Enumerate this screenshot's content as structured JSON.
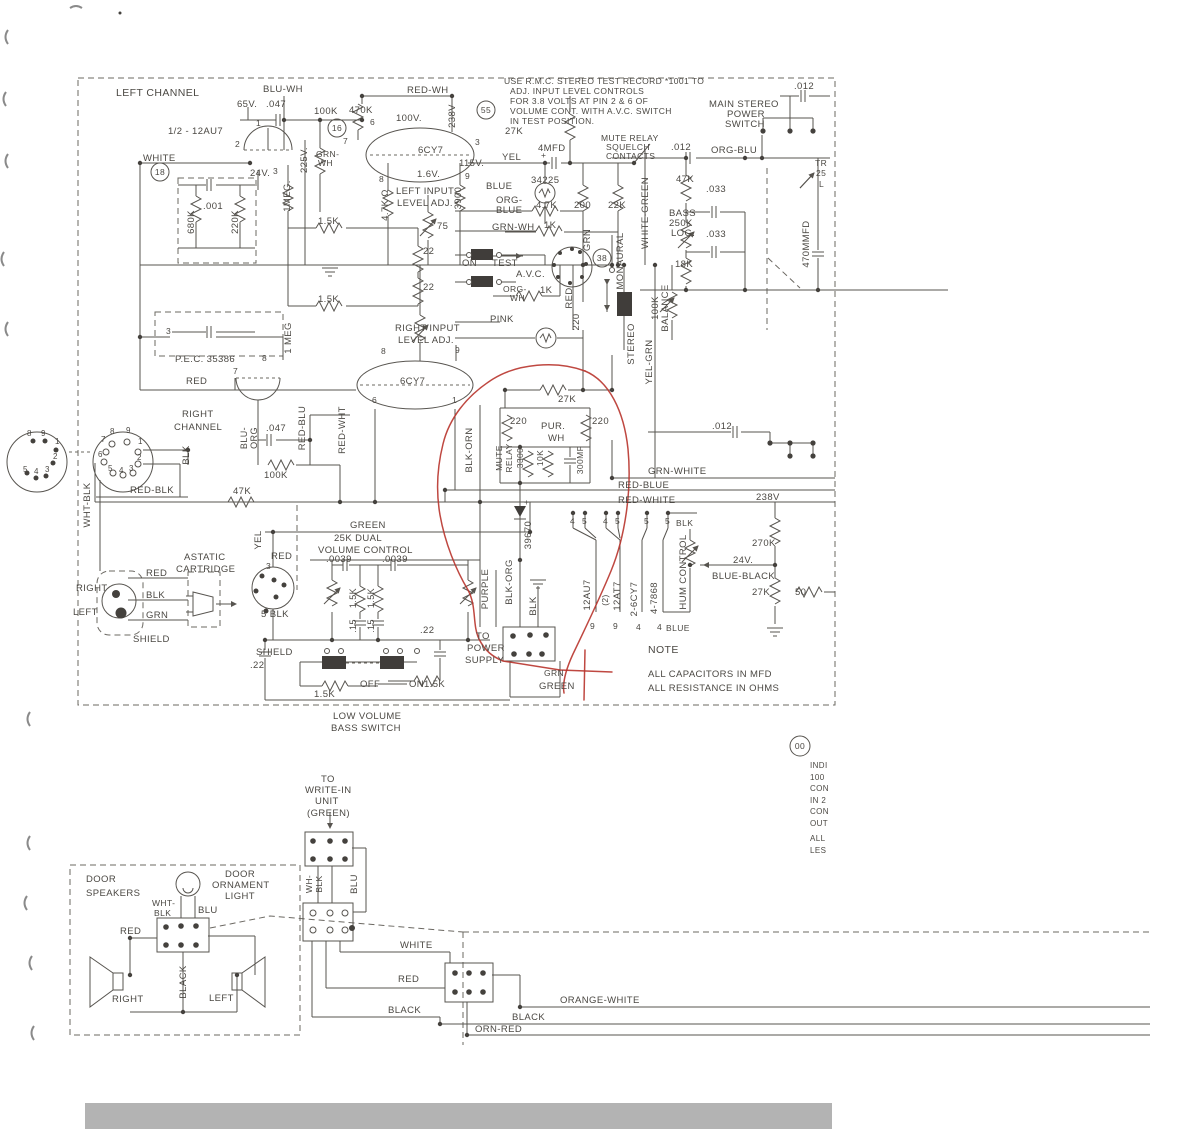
{
  "style": {
    "ink_color": "#4b4843",
    "red_annotation_color": "#b8342c",
    "scan_bar_color": "#b3b3b3",
    "background": "#ffffff"
  },
  "circled_refs": [
    {
      "t": "18",
      "x": 160,
      "y": 172
    },
    {
      "t": "16",
      "x": 337,
      "y": 128
    },
    {
      "t": "55",
      "x": 486,
      "y": 110
    },
    {
      "t": "38",
      "x": 602,
      "y": 258
    },
    {
      "t": "00",
      "x": 800,
      "y": 746
    }
  ],
  "labels": [
    {
      "t": "USE R.M.C. STEREO TEST RECORD *1001 TO",
      "x": 504,
      "y": 84,
      "s": 8.5
    },
    {
      "t": "ADJ. INPUT LEVEL CONTROLS",
      "x": 510,
      "y": 94,
      "s": 8.5
    },
    {
      "t": "FOR 3.8 VOLTS AT PIN 2 & 6 OF",
      "x": 510,
      "y": 104,
      "s": 8.5
    },
    {
      "t": "VOLUME CONT. WITH A.V.C. SWITCH",
      "x": 510,
      "y": 114,
      "s": 8.5
    },
    {
      "t": "IN TEST POSITION.",
      "x": 510,
      "y": 124,
      "s": 8.5
    },
    {
      "t": "LEFT CHANNEL",
      "x": 116,
      "y": 96,
      "s": 10.5
    },
    {
      "t": "1/2 - 12AU7",
      "x": 168,
      "y": 134
    },
    {
      "t": "WHITE",
      "x": 143,
      "y": 161
    },
    {
      "t": "BLU-WH",
      "x": 263,
      "y": 92
    },
    {
      "t": "65V.",
      "x": 237,
      "y": 107
    },
    {
      "t": ".047",
      "x": 266,
      "y": 107
    },
    {
      "t": "100K",
      "x": 314,
      "y": 114
    },
    {
      "t": "470K",
      "x": 349,
      "y": 113
    },
    {
      "t": "RED-WH",
      "x": 407,
      "y": 93
    },
    {
      "t": "100V.",
      "x": 396,
      "y": 121
    },
    {
      "t": "238V",
      "x": 455,
      "y": 116,
      "r": -90,
      "m": 1
    },
    {
      "t": "6CY7",
      "x": 418,
      "y": 153
    },
    {
      "t": "1.6V.",
      "x": 417,
      "y": 177
    },
    {
      "t": "115V.",
      "x": 459,
      "y": 166
    },
    {
      "t": "YEL",
      "x": 502,
      "y": 160
    },
    {
      "t": "27K",
      "x": 505,
      "y": 134
    },
    {
      "t": "4MFD",
      "x": 538,
      "y": 151
    },
    {
      "t": "+",
      "x": 541,
      "y": 158,
      "s": 8.5
    },
    {
      "t": "34225",
      "x": 531,
      "y": 183
    },
    {
      "t": "BLUE",
      "x": 486,
      "y": 189
    },
    {
      "t": "ORG-",
      "x": 496,
      "y": 203
    },
    {
      "t": "BLUE",
      "x": 496,
      "y": 213
    },
    {
      "t": "GRN-WH",
      "x": 492,
      "y": 230
    },
    {
      "t": "4.7K",
      "x": 536,
      "y": 208
    },
    {
      "t": "200",
      "x": 574,
      "y": 208
    },
    {
      "t": "22K",
      "x": 608,
      "y": 208
    },
    {
      "t": "1K",
      "x": 544,
      "y": 228
    },
    {
      "t": "GRN",
      "x": 590,
      "y": 240,
      "r": -90,
      "m": 1
    },
    {
      "t": "GRN-",
      "x": 316,
      "y": 157,
      "s": 8.5
    },
    {
      "t": "WH",
      "x": 318,
      "y": 166,
      "s": 8.5
    },
    {
      "t": "225V.",
      "x": 307,
      "y": 160,
      "r": -90,
      "m": 1
    },
    {
      "t": "24V.",
      "x": 250,
      "y": 176
    },
    {
      "t": "1MEG.",
      "x": 290,
      "y": 196,
      "r": -90,
      "m": 1
    },
    {
      "t": "680K",
      "x": 194,
      "y": 222,
      "r": -90,
      "m": 1
    },
    {
      "t": ".001",
      "x": 203,
      "y": 209
    },
    {
      "t": "220K",
      "x": 238,
      "y": 222,
      "r": -90,
      "m": 1
    },
    {
      "t": "1.5K",
      "x": 318,
      "y": 224
    },
    {
      "t": "1.5K",
      "x": 318,
      "y": 302
    },
    {
      "t": "4.7K Ω",
      "x": 388,
      "y": 205,
      "r": -90,
      "m": 1
    },
    {
      "t": "3900",
      "x": 461,
      "y": 198,
      "r": -90,
      "m": 1
    },
    {
      "t": "LEFT INPUT",
      "x": 396,
      "y": 194
    },
    {
      "t": "LEVEL ADJ.",
      "x": 397,
      "y": 206
    },
    {
      "t": "75",
      "x": 437,
      "y": 229
    },
    {
      "t": "22",
      "x": 423,
      "y": 254
    },
    {
      "t": "22",
      "x": 423,
      "y": 290
    },
    {
      "t": "ON",
      "x": 462,
      "y": 266
    },
    {
      "t": "TEST",
      "x": 492,
      "y": 266
    },
    {
      "t": "A.V.C.",
      "x": 516,
      "y": 277
    },
    {
      "t": "ORG-",
      "x": 503,
      "y": 292,
      "s": 8.5
    },
    {
      "t": "WH",
      "x": 510,
      "y": 301,
      "s": 8.5
    },
    {
      "t": "1K",
      "x": 540,
      "y": 293
    },
    {
      "t": "PINK",
      "x": 490,
      "y": 322
    },
    {
      "t": "RED",
      "x": 572,
      "y": 298,
      "r": -90,
      "m": 1
    },
    {
      "t": "220",
      "x": 579,
      "y": 322,
      "r": -90,
      "m": 1
    },
    {
      "t": "MUTE RELAY",
      "x": 601,
      "y": 141,
      "s": 8.5
    },
    {
      "t": "SQUELCH",
      "x": 606,
      "y": 150,
      "s": 8.5
    },
    {
      "t": "CONTACTS",
      "x": 606,
      "y": 159,
      "s": 8.5
    },
    {
      "t": "MONAURAL",
      "x": 623,
      "y": 261,
      "r": -90,
      "m": 1
    },
    {
      "t": "STEREO",
      "x": 634,
      "y": 344,
      "r": -90,
      "m": 1
    },
    {
      "t": "YEL-GRN",
      "x": 652,
      "y": 362,
      "r": -90,
      "m": 1
    },
    {
      "t": "100K",
      "x": 658,
      "y": 308,
      "r": -90,
      "m": 1
    },
    {
      "t": "BALANCE",
      "x": 668,
      "y": 308,
      "r": -90,
      "m": 1
    },
    {
      "t": "WHITE-GREEN",
      "x": 648,
      "y": 213,
      "r": -90,
      "m": 1
    },
    {
      "t": ".012",
      "x": 671,
      "y": 150
    },
    {
      "t": "ORG-BLU",
      "x": 711,
      "y": 153
    },
    {
      "t": "MAIN STEREO",
      "x": 709,
      "y": 107
    },
    {
      "t": "POWER",
      "x": 727,
      "y": 117
    },
    {
      "t": "SWITCH",
      "x": 725,
      "y": 127
    },
    {
      "t": ".012",
      "x": 794,
      "y": 89
    },
    {
      "t": "47K",
      "x": 676,
      "y": 182
    },
    {
      "t": ".033",
      "x": 706,
      "y": 192
    },
    {
      "t": "BASS",
      "x": 669,
      "y": 216
    },
    {
      "t": "250K",
      "x": 669,
      "y": 226
    },
    {
      "t": "LOG.",
      "x": 671,
      "y": 236
    },
    {
      "t": ".033",
      "x": 706,
      "y": 237
    },
    {
      "t": "18K",
      "x": 675,
      "y": 267
    },
    {
      "t": "TR",
      "x": 815,
      "y": 166,
      "s": 8.5
    },
    {
      "t": "25",
      "x": 816,
      "y": 176,
      "s": 8.5
    },
    {
      "t": "L",
      "x": 819,
      "y": 187,
      "s": 8.5
    },
    {
      "t": "470MMFD",
      "x": 809,
      "y": 244,
      "r": -90,
      "m": 1
    },
    {
      "t": ".012",
      "x": 712,
      "y": 429
    },
    {
      "t": "P.E.C. 35386",
      "x": 175,
      "y": 362
    },
    {
      "t": "RED",
      "x": 186,
      "y": 384
    },
    {
      "t": "1 MEG",
      "x": 291,
      "y": 338,
      "r": -90,
      "m": 1
    },
    {
      "t": "RIGHT",
      "x": 182,
      "y": 417
    },
    {
      "t": "CHANNEL",
      "x": 174,
      "y": 430
    },
    {
      "t": "RIGHT INPUT",
      "x": 395,
      "y": 331
    },
    {
      "t": "LEVEL ADJ.",
      "x": 398,
      "y": 343
    },
    {
      "t": "6CY7",
      "x": 400,
      "y": 384
    },
    {
      "t": "BLU-",
      "x": 247,
      "y": 438,
      "r": -90,
      "m": 1,
      "s": 9
    },
    {
      "t": "ORG",
      "x": 257,
      "y": 438,
      "r": -90,
      "m": 1,
      "s": 9
    },
    {
      "t": ".047",
      "x": 266,
      "y": 431
    },
    {
      "t": "RED-BLU",
      "x": 305,
      "y": 428,
      "r": -90,
      "m": 1
    },
    {
      "t": "RED-WHT",
      "x": 345,
      "y": 430,
      "r": -90,
      "m": 1
    },
    {
      "t": "100K",
      "x": 264,
      "y": 478
    },
    {
      "t": "BLK",
      "x": 189,
      "y": 455,
      "r": -90,
      "m": 1
    },
    {
      "t": "47K",
      "x": 233,
      "y": 494
    },
    {
      "t": "RED-BLK",
      "x": 130,
      "y": 493
    },
    {
      "t": "WHT-BLK",
      "x": 90,
      "y": 505,
      "r": -90,
      "m": 1
    },
    {
      "t": "1",
      "x": 256,
      "y": 126,
      "s": 8.5
    },
    {
      "t": "2",
      "x": 235,
      "y": 147,
      "s": 8.5
    },
    {
      "t": "3",
      "x": 273,
      "y": 174,
      "s": 8.5
    },
    {
      "t": "6",
      "x": 370,
      "y": 125,
      "s": 8.5
    },
    {
      "t": "7",
      "x": 343,
      "y": 144,
      "s": 8.5
    },
    {
      "t": "3",
      "x": 475,
      "y": 145,
      "s": 8.5
    },
    {
      "t": "8",
      "x": 379,
      "y": 182,
      "s": 8.5
    },
    {
      "t": "9",
      "x": 465,
      "y": 179,
      "s": 8.5
    },
    {
      "t": "3",
      "x": 166,
      "y": 334,
      "s": 8.5
    },
    {
      "t": "8",
      "x": 262,
      "y": 361,
      "s": 8.5
    },
    {
      "t": "7",
      "x": 233,
      "y": 374,
      "s": 8.5
    },
    {
      "t": "8",
      "x": 381,
      "y": 354,
      "s": 8.5
    },
    {
      "t": "9",
      "x": 455,
      "y": 353,
      "s": 8.5
    },
    {
      "t": "6",
      "x": 372,
      "y": 403,
      "s": 8.5
    },
    {
      "t": "1",
      "x": 452,
      "y": 403,
      "s": 8.5
    },
    {
      "t": "8",
      "x": 27,
      "y": 436,
      "s": 8
    },
    {
      "t": "9",
      "x": 41,
      "y": 436,
      "s": 8
    },
    {
      "t": "1",
      "x": 55,
      "y": 444,
      "s": 8
    },
    {
      "t": "2",
      "x": 53,
      "y": 459,
      "s": 8
    },
    {
      "t": "3",
      "x": 45,
      "y": 472,
      "s": 8
    },
    {
      "t": "4",
      "x": 34,
      "y": 474,
      "s": 8
    },
    {
      "t": "5",
      "x": 23,
      "y": 472,
      "s": 8
    },
    {
      "t": "7",
      "x": 101,
      "y": 442,
      "s": 8
    },
    {
      "t": "8",
      "x": 110,
      "y": 434,
      "s": 8
    },
    {
      "t": "9",
      "x": 126,
      "y": 433,
      "s": 8
    },
    {
      "t": "6",
      "x": 98,
      "y": 457,
      "s": 8
    },
    {
      "t": "1",
      "x": 138,
      "y": 444,
      "s": 8
    },
    {
      "t": "2",
      "x": 137,
      "y": 460,
      "s": 8
    },
    {
      "t": "5",
      "x": 108,
      "y": 471,
      "s": 8
    },
    {
      "t": "4",
      "x": 119,
      "y": 473,
      "s": 8
    },
    {
      "t": "3",
      "x": 129,
      "y": 471,
      "s": 8
    },
    {
      "t": "RIGHT",
      "x": 76,
      "y": 591
    },
    {
      "t": "LEFT",
      "x": 73,
      "y": 615
    },
    {
      "t": "RED",
      "x": 146,
      "y": 576
    },
    {
      "t": "BLK",
      "x": 146,
      "y": 598
    },
    {
      "t": "GRN",
      "x": 146,
      "y": 618
    },
    {
      "t": "SHIELD",
      "x": 133,
      "y": 642
    },
    {
      "t": "ASTATIC",
      "x": 184,
      "y": 560
    },
    {
      "t": "CARTRIDGE",
      "x": 176,
      "y": 572
    },
    {
      "t": "GREEN",
      "x": 350,
      "y": 528
    },
    {
      "t": "25K DUAL",
      "x": 334,
      "y": 541
    },
    {
      "t": "VOLUME CONTROL",
      "x": 318,
      "y": 553
    },
    {
      "t": ".0039",
      "x": 326,
      "y": 562
    },
    {
      "t": ".0039",
      "x": 382,
      "y": 562
    },
    {
      "t": "YEL",
      "x": 261,
      "y": 540,
      "r": -90,
      "m": 1
    },
    {
      "t": "RED",
      "x": 271,
      "y": 559
    },
    {
      "t": "3",
      "x": 266,
      "y": 569,
      "s": 8.5
    },
    {
      "t": "5 BLK",
      "x": 261,
      "y": 617
    },
    {
      "t": "SHIELD",
      "x": 256,
      "y": 655
    },
    {
      "t": ".22",
      "x": 250,
      "y": 668
    },
    {
      "t": "1.5K",
      "x": 356,
      "y": 598,
      "r": -90,
      "m": 1,
      "s": 9
    },
    {
      "t": "1.5K",
      "x": 374,
      "y": 598,
      "r": -90,
      "m": 1,
      "s": 9
    },
    {
      "t": ".15",
      "x": 356,
      "y": 626,
      "r": -90,
      "m": 1,
      "s": 9
    },
    {
      "t": ".15",
      "x": 374,
      "y": 626,
      "r": -90,
      "m": 1,
      "s": 9
    },
    {
      "t": ".22",
      "x": 420,
      "y": 633
    },
    {
      "t": "1.5K",
      "x": 314,
      "y": 697
    },
    {
      "t": "OFF",
      "x": 360,
      "y": 687
    },
    {
      "t": "ON",
      "x": 409,
      "y": 687
    },
    {
      "t": "1.5K",
      "x": 424,
      "y": 687
    },
    {
      "t": "LOW VOLUME",
      "x": 333,
      "y": 719
    },
    {
      "t": "BASS SWITCH",
      "x": 331,
      "y": 731
    },
    {
      "t": "27K",
      "x": 558,
      "y": 402
    },
    {
      "t": "220",
      "x": 510,
      "y": 424
    },
    {
      "t": "220",
      "x": 592,
      "y": 424
    },
    {
      "t": "PUR.",
      "x": 541,
      "y": 429
    },
    {
      "t": "WH",
      "x": 548,
      "y": 441
    },
    {
      "t": "MUTE",
      "x": 502,
      "y": 458,
      "r": -90,
      "m": 1,
      "s": 8.5
    },
    {
      "t": "RELAY",
      "x": 512,
      "y": 458,
      "r": -90,
      "m": 1,
      "s": 8.5
    },
    {
      "t": "3300",
      "x": 523,
      "y": 458,
      "r": -90,
      "m": 1,
      "s": 8.5
    },
    {
      "t": "10K",
      "x": 543,
      "y": 458,
      "r": -90,
      "m": 1,
      "s": 8.5
    },
    {
      "t": "300MF",
      "x": 583,
      "y": 460,
      "r": -90,
      "m": 1,
      "s": 8.5
    },
    {
      "t": "BLK-ORN",
      "x": 472,
      "y": 450,
      "r": -90,
      "m": 1
    },
    {
      "t": "GRN-WHITE",
      "x": 648,
      "y": 474
    },
    {
      "t": "RED-BLUE",
      "x": 618,
      "y": 488
    },
    {
      "t": "RED-WHITE",
      "x": 618,
      "y": 503
    },
    {
      "t": "238V",
      "x": 756,
      "y": 500
    },
    {
      "t": "39670",
      "x": 531,
      "y": 535,
      "r": -90,
      "m": 1
    },
    {
      "t": "+",
      "x": 524,
      "y": 505,
      "s": 8.5
    },
    {
      "t": "4",
      "x": 570,
      "y": 524,
      "s": 8.5
    },
    {
      "t": "5",
      "x": 582,
      "y": 524,
      "s": 8.5
    },
    {
      "t": "4",
      "x": 603,
      "y": 524,
      "s": 8.5
    },
    {
      "t": "5",
      "x": 615,
      "y": 524,
      "s": 8.5
    },
    {
      "t": "5",
      "x": 644,
      "y": 524,
      "s": 8.5
    },
    {
      "t": "5",
      "x": 665,
      "y": 524,
      "s": 8.5
    },
    {
      "t": "BLK",
      "x": 676,
      "y": 526,
      "s": 8.5
    },
    {
      "t": "PURPLE",
      "x": 488,
      "y": 589,
      "r": -90,
      "m": 1
    },
    {
      "t": "BLK-ORG",
      "x": 512,
      "y": 582,
      "r": -90,
      "m": 1
    },
    {
      "t": "BLK",
      "x": 536,
      "y": 606,
      "r": -90,
      "m": 1
    },
    {
      "t": "12AU7",
      "x": 590,
      "y": 595,
      "r": -90,
      "m": 1
    },
    {
      "t": "(2)",
      "x": 608,
      "y": 600,
      "r": -90,
      "m": 1,
      "s": 8.5
    },
    {
      "t": "12AT7",
      "x": 620,
      "y": 596,
      "r": -90,
      "m": 1
    },
    {
      "t": "2-6CY7",
      "x": 637,
      "y": 599,
      "r": -90,
      "m": 1
    },
    {
      "t": "4-7868",
      "x": 657,
      "y": 598,
      "r": -90,
      "m": 1
    },
    {
      "t": "HUM CONTROL",
      "x": 686,
      "y": 572,
      "r": -90,
      "m": 1
    },
    {
      "t": "9",
      "x": 590,
      "y": 629,
      "s": 8.5
    },
    {
      "t": "9",
      "x": 613,
      "y": 629,
      "s": 8.5
    },
    {
      "t": "4",
      "x": 636,
      "y": 630,
      "s": 8.5
    },
    {
      "t": "4",
      "x": 657,
      "y": 630,
      "s": 8.5
    },
    {
      "t": "BLUE",
      "x": 666,
      "y": 631,
      "s": 8.5
    },
    {
      "t": "TO",
      "x": 476,
      "y": 639
    },
    {
      "t": "POWER",
      "x": 467,
      "y": 651
    },
    {
      "t": "SUPPLY",
      "x": 465,
      "y": 663
    },
    {
      "t": "GRN",
      "x": 544,
      "y": 676,
      "s": 8.5
    },
    {
      "t": "GREEN",
      "x": 539,
      "y": 689
    },
    {
      "t": "NOTE",
      "x": 648,
      "y": 653,
      "s": 10.5
    },
    {
      "t": "ALL CAPACITORS IN MFD",
      "x": 648,
      "y": 677
    },
    {
      "t": "ALL RESISTANCE IN OHMS",
      "x": 648,
      "y": 691
    },
    {
      "t": "270K",
      "x": 752,
      "y": 546
    },
    {
      "t": "24V.",
      "x": 733,
      "y": 563
    },
    {
      "t": "BLUE-BLACK",
      "x": 712,
      "y": 579
    },
    {
      "t": "27K",
      "x": 752,
      "y": 595
    },
    {
      "t": "50",
      "x": 795,
      "y": 595
    },
    {
      "t": "INDI",
      "x": 810,
      "y": 768,
      "s": 8
    },
    {
      "t": "100",
      "x": 810,
      "y": 780,
      "s": 8
    },
    {
      "t": "CON",
      "x": 810,
      "y": 791,
      "s": 8
    },
    {
      "t": "IN 2",
      "x": 810,
      "y": 803,
      "s": 8
    },
    {
      "t": "CON",
      "x": 810,
      "y": 814,
      "s": 8
    },
    {
      "t": "OUT",
      "x": 810,
      "y": 826,
      "s": 8
    },
    {
      "t": "ALL",
      "x": 810,
      "y": 841,
      "s": 8
    },
    {
      "t": "LES",
      "x": 810,
      "y": 853,
      "s": 8
    },
    {
      "t": "DOOR",
      "x": 86,
      "y": 882
    },
    {
      "t": "SPEAKERS",
      "x": 86,
      "y": 896
    },
    {
      "t": "DOOR",
      "x": 225,
      "y": 877
    },
    {
      "t": "ORNAMENT",
      "x": 212,
      "y": 888
    },
    {
      "t": "LIGHT",
      "x": 225,
      "y": 899
    },
    {
      "t": "WHT-",
      "x": 152,
      "y": 906,
      "s": 8.5
    },
    {
      "t": "BLK",
      "x": 154,
      "y": 916,
      "s": 8.5
    },
    {
      "t": "BLU",
      "x": 198,
      "y": 913
    },
    {
      "t": "RED",
      "x": 120,
      "y": 934
    },
    {
      "t": "BLACK",
      "x": 186,
      "y": 982,
      "r": -90,
      "m": 1
    },
    {
      "t": "RIGHT",
      "x": 112,
      "y": 1002
    },
    {
      "t": "LEFT",
      "x": 209,
      "y": 1001
    },
    {
      "t": "TO",
      "x": 321,
      "y": 782
    },
    {
      "t": "WRITE-IN",
      "x": 305,
      "y": 793
    },
    {
      "t": "UNIT",
      "x": 315,
      "y": 804
    },
    {
      "t": "(GREEN)",
      "x": 307,
      "y": 816
    },
    {
      "t": "WH-",
      "x": 312,
      "y": 884,
      "r": -90,
      "m": 1,
      "s": 8.5
    },
    {
      "t": "BLK",
      "x": 322,
      "y": 884,
      "r": -90,
      "m": 1,
      "s": 8.5
    },
    {
      "t": "BLU",
      "x": 357,
      "y": 884,
      "r": -90,
      "m": 1
    },
    {
      "t": "WHITE",
      "x": 400,
      "y": 948
    },
    {
      "t": "RED",
      "x": 398,
      "y": 982
    },
    {
      "t": "BLACK",
      "x": 388,
      "y": 1013
    },
    {
      "t": "ORANGE-WHITE",
      "x": 560,
      "y": 1003
    },
    {
      "t": "BLACK",
      "x": 512,
      "y": 1020
    },
    {
      "t": "ORN-RED",
      "x": 475,
      "y": 1032
    }
  ]
}
